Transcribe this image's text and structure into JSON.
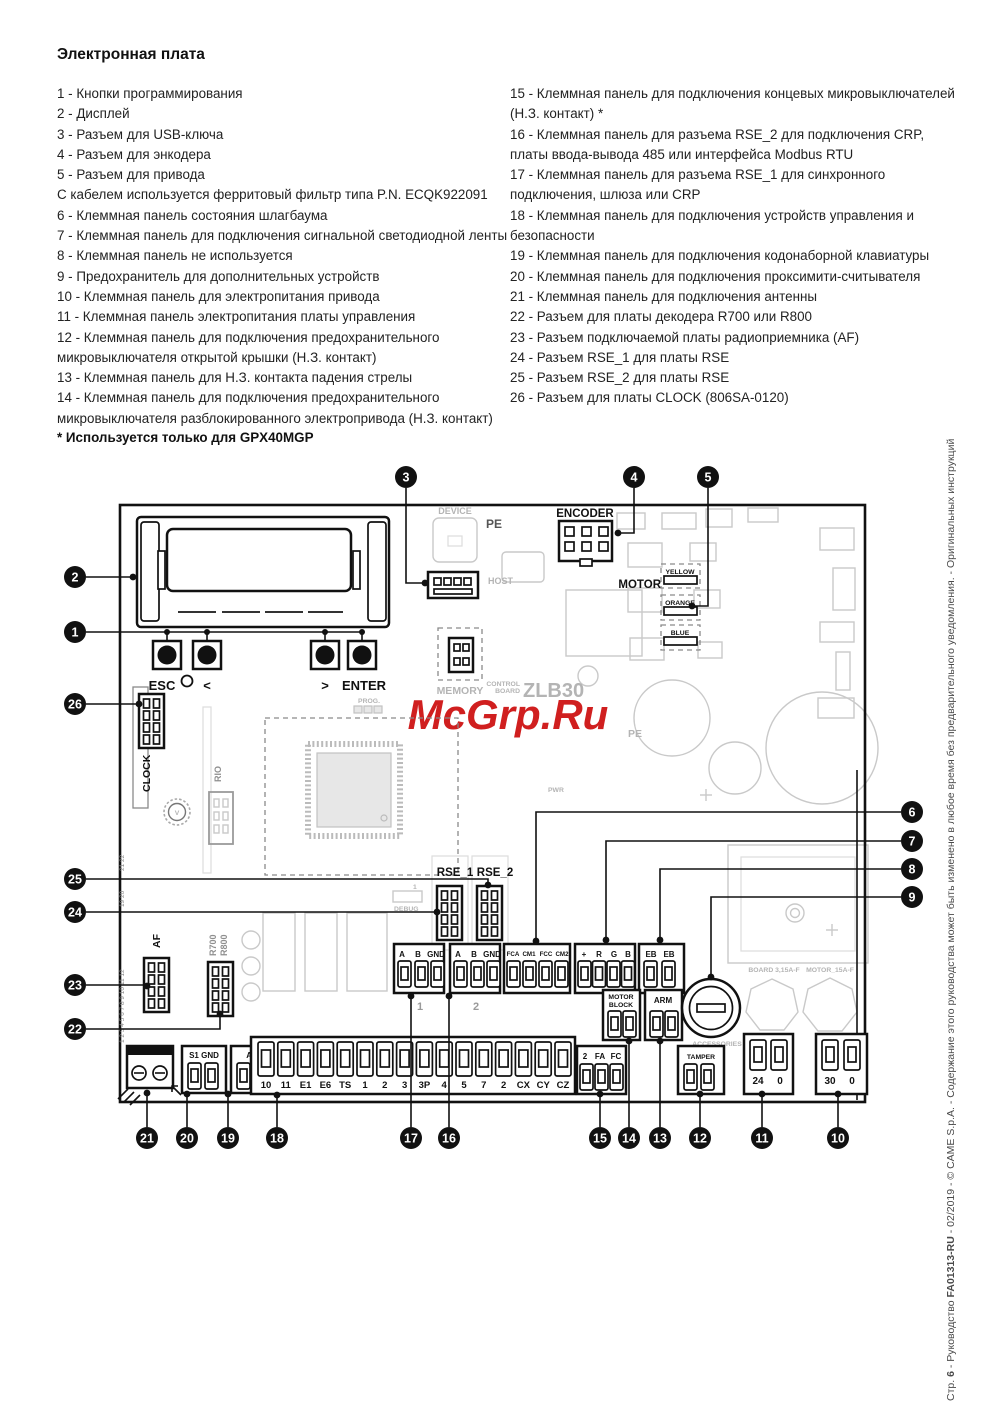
{
  "page": {
    "title": "Электронная плата",
    "note": "* Используется только для GPX40MGP"
  },
  "legend_left": [
    "1 - Кнопки программирования",
    "2 - Дисплей",
    "3 - Разъем для USB-ключа",
    "4 - Разъем для энкодера",
    "5 - Разъем для привода",
    "С кабелем используется ферритовый фильтр типа P.N. ECQK922091",
    "6 - Клеммная панель состояния шлагбаума",
    "7 - Клеммная панель для подключения сигнальной светодиодной ленты",
    "8 - Клеммная панель не используется",
    "9 - Предохранитель для дополнительных устройств",
    "10 - Клеммная панель для электропитания привода",
    "11 - Клеммная панель электропитания платы управления",
    "12 - Клеммная панель для подключения предохранительного микровыключателя открытой крышки (Н.З. контакт)",
    "13 - Клеммная панель для Н.З. контакта падения стрелы",
    "14 - Клеммная панель для подключения предохранительного микровыключателя разблокированного электропривода (Н.З. контакт)"
  ],
  "legend_right": [
    "15 - Клеммная панель для подключения концевых микровыключателей (Н.З. контакт) *",
    "16 - Клеммная панель для разъема RSE_2 для подключения CRP, платы ввода-вывода 485 или интерфейса Modbus RTU",
    "17 - Клеммная панель для разъема RSE_1 для синхронного подключения, шлюза или CRP",
    "18 - Клеммная панель для подключения устройств управления и безопасности",
    "19 - Клеммная панель для подключения кодонаборной клавиатуры",
    "20 - Клеммная панель для подключения проксимити-считывателя",
    "21 - Клеммная панель для подключения антенны",
    "22 - Разъем для платы декодера R700 или R800",
    "23 - Разъем подключаемой платы радиоприемника (AF)",
    "24 - Разъем RSE_1 для платы RSE",
    "25 - Разъем RSE_2 для платы RSE",
    "26 - Разъем для платы CLOCK (806SA-0120)"
  ],
  "footer": {
    "parts": [
      {
        "t": "Стр. "
      },
      {
        "t": "6"
      },
      {
        "t": " - Руководство "
      },
      {
        "t": "FA01313-RU"
      },
      {
        "t": " - 02/2019 - © CAME S.p.A. - Содержание этого руководства может быть изменено в любое время без предварительного уведомления. - Оригинальных инструкций"
      }
    ]
  },
  "d": {
    "callouts": [
      "1",
      "2",
      "3",
      "4",
      "5",
      "6",
      "7",
      "8",
      "9",
      "10",
      "11",
      "12",
      "13",
      "14",
      "15",
      "16",
      "17",
      "18",
      "19",
      "20",
      "21",
      "22",
      "23",
      "24",
      "25",
      "26"
    ],
    "esc": "ESC",
    "lt": "<",
    "gt": ">",
    "enter": "ENTER",
    "device": "DEVICE",
    "pe": "PE",
    "host": "HOST",
    "encoder": "ENCODER",
    "motor": "MOTOR",
    "yellow": "YELLOW",
    "orange": "ORANGE",
    "blue": "BLUE",
    "memory": "MEMORY",
    "control": "CONTROL",
    "board": "BOARD",
    "zlb": "ZLB30",
    "prog": "PROG.",
    "clock": "CLOCK",
    "rio": "RIO",
    "v": "V",
    "pe2": "PE",
    "pwr": "PWR",
    "rse1": "RSE_1",
    "rse2": "RSE_2",
    "debug": "DEBUG",
    "one": "1",
    "two": "2",
    "af": "AF",
    "r700": "R700",
    "r800": "R800",
    "nums_bottom": "1 2 3 4 5 6 7 8 9 10 11 12",
    "nums_mid": "19 20",
    "nums_top": "21 22",
    "s1gnd": "S1 GND",
    "ab": "A  B",
    "strip": [
      "10",
      "11",
      "E1",
      "E6",
      "TS",
      "1",
      "2",
      "3",
      "3P",
      "4",
      "5",
      "7",
      "2",
      "CX",
      "CY",
      "CZ"
    ],
    "abgnd": [
      "A",
      "B",
      "GND"
    ],
    "fca": [
      "FCA",
      "CM1",
      "FCC",
      "CM2"
    ],
    "rgb": [
      "+",
      "R",
      "G",
      "B"
    ],
    "eb": [
      "EB",
      "EB"
    ],
    "motorblock": [
      "MOTOR",
      "BLOCK"
    ],
    "arm": "ARM",
    "fafc": [
      "2",
      "FA",
      "FC"
    ],
    "tamper": "TAMPER",
    "v24": [
      "24",
      "0"
    ],
    "v30": [
      "30",
      "0"
    ],
    "fuse_board": "BOARD 3,15A-F",
    "fuse_motor": "MOTOR_15A-F",
    "acc1": "ACCESSORIES",
    "acc2": "2A-F",
    "watermark": "McGrp.Ru"
  }
}
